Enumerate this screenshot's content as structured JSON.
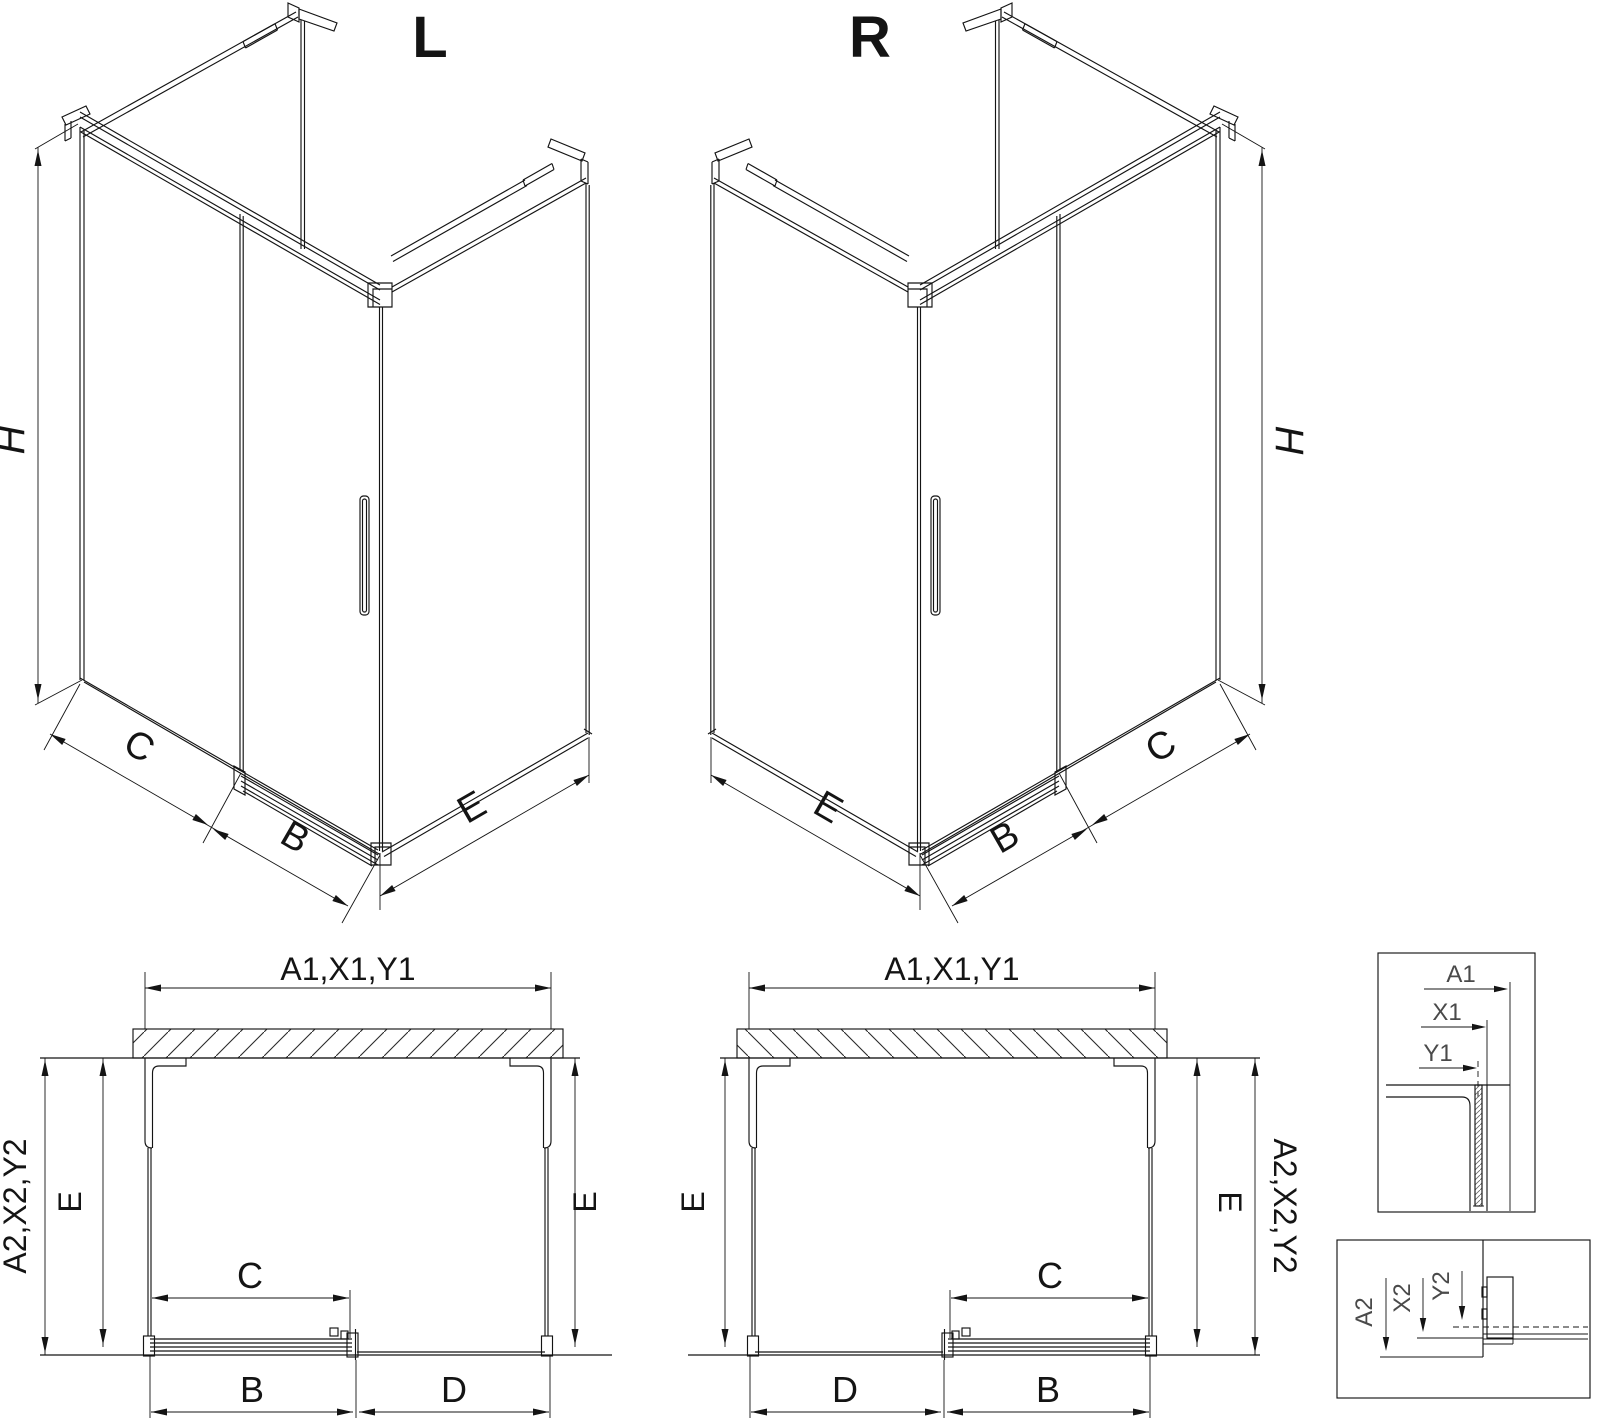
{
  "drawing": {
    "background": "#ffffff",
    "line_color": "#141414",
    "detail_label_color": "#4a4a4a"
  },
  "iso_left": {
    "title": "L",
    "height_label": "H",
    "fixed_width_label": "C",
    "door_width_label": "B",
    "side_width_label": "E"
  },
  "iso_right": {
    "title": "R",
    "height_label": "H",
    "fixed_width_label": "C",
    "door_width_label": "B",
    "side_width_label": "E"
  },
  "plan_left": {
    "top_width_label": "A1,X1,Y1",
    "outer_depth_label": "A2,X2,Y2",
    "left_depth_label": "E",
    "right_depth_label": "E",
    "door_opening_label": "C",
    "door_panel_label": "B",
    "fixed_panel_label": "D"
  },
  "plan_right": {
    "top_width_label": "A1,X1,Y1",
    "outer_depth_label": "A2,X2,Y2",
    "left_depth_label": "E",
    "right_depth_label": "E",
    "door_opening_label": "C",
    "door_panel_label": "B",
    "fixed_panel_label": "D"
  },
  "detail_top": {
    "dim1": "A1",
    "dim2": "X1",
    "dim3": "Y1"
  },
  "detail_bottom": {
    "dim1": "A2",
    "dim2": "X2",
    "dim3": "Y2"
  }
}
